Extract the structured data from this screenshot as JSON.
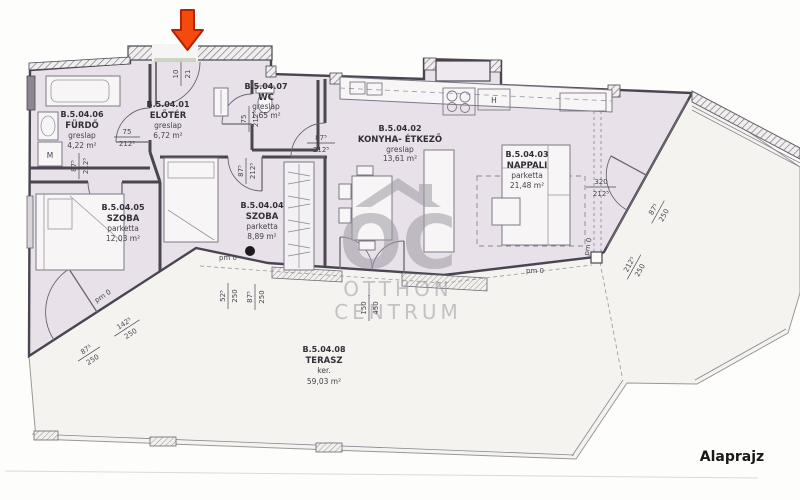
{
  "plan": {
    "caption": "Alaprajz",
    "colors": {
      "floor": "#e8e1ea",
      "terrace": "#f4f3f0",
      "arrow": "#f4490f",
      "watermark": "#9d9aa3"
    },
    "rooms": [
      {
        "id": "B.5.04.06",
        "name": "FÜRDŐ",
        "floor": "greslap",
        "area": "4,22 m²"
      },
      {
        "id": "B.5.04.01",
        "name": "ELŐTÉR",
        "floor": "greslap",
        "area": "6,72 m²"
      },
      {
        "id": "B.5.04.07",
        "name": "WC",
        "floor": "greslap",
        "area": "1,65 m²"
      },
      {
        "id": "B.5.04.02",
        "name": "KONYHA- ÉTKEZŐ",
        "floor": "greslap",
        "area": "13,61 m²"
      },
      {
        "id": "B.5.04.03",
        "name": "NAPPALI",
        "floor": "parketta",
        "area": "21,48 m²"
      },
      {
        "id": "B.5.04.05",
        "name": "SZOBA",
        "floor": "parketta",
        "area": "12,03 m²"
      },
      {
        "id": "B.5.04.04",
        "name": "SZOBA",
        "floor": "parketta",
        "area": "8,89 m²"
      },
      {
        "id": "B.5.04.08",
        "name": "TERASZ",
        "floor": "ker.",
        "area": "59,03 m²"
      }
    ],
    "dims": [
      {
        "a": "10",
        "b": "21"
      },
      {
        "a": "75",
        "b": "212⁵"
      },
      {
        "a": "87⁵",
        "b": "212⁵"
      },
      {
        "a": "75",
        "b": "212⁵"
      },
      {
        "a": "87⁵",
        "b": "212⁵"
      },
      {
        "a": "87⁵",
        "b": "212⁵"
      },
      {
        "a": "320",
        "b": "212⁵"
      },
      {
        "a": "87⁵",
        "b": "250"
      },
      {
        "a": "212⁵",
        "b": "250"
      },
      {
        "a": "52⁵",
        "b": "250"
      },
      {
        "a": "87⁵",
        "b": "250"
      },
      {
        "a": "150",
        "b": "450"
      },
      {
        "a": "142⁵",
        "b": "250"
      },
      {
        "a": "87⁵",
        "b": "250"
      }
    ],
    "pm_labels": [
      "pm 0",
      "pm 0",
      "pm 0",
      "pm 0"
    ],
    "letters": {
      "fridge": "H",
      "washer": "M"
    },
    "watermark": {
      "abbr": "OC",
      "line1": "OTTHON",
      "line2": "CENTRUM"
    }
  }
}
